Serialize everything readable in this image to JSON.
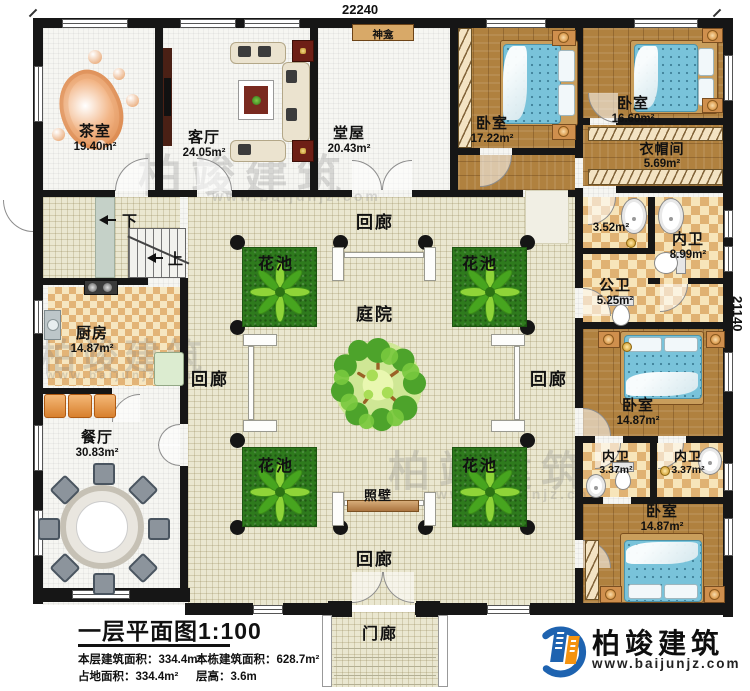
{
  "dimensions": {
    "top": "22240",
    "right": "21140"
  },
  "rooms": {
    "tea_room": {
      "name": "茶室",
      "area": "19.40m²"
    },
    "living_room": {
      "name": "客厅",
      "area": "24.05m²"
    },
    "main_hall": {
      "name": "堂屋",
      "area": "20.43m²"
    },
    "shrine": {
      "name": "神龛"
    },
    "bedroom_top_mid": {
      "name": "卧室",
      "area": "17.22m²"
    },
    "bedroom_top_right": {
      "name": "卧室",
      "area": "16.60m²"
    },
    "cloakroom": {
      "name": "衣帽间",
      "area": "5.69m²"
    },
    "bath_small": {
      "area": "3.52m²"
    },
    "ensuite_main": {
      "name": "内卫",
      "area": "8.99m²"
    },
    "public_bath": {
      "name": "公卫",
      "area": "5.25m²"
    },
    "bedroom_mid_right": {
      "name": "卧室",
      "area": "14.87m²"
    },
    "ensuite_left": {
      "name": "内卫",
      "area": "3.37m²"
    },
    "ensuite_right": {
      "name": "内卫",
      "area": "3.37m²"
    },
    "bedroom_bot_right": {
      "name": "卧室",
      "area": "14.87m²"
    },
    "kitchen": {
      "name": "厨房",
      "area": "14.87m²"
    },
    "dining_room": {
      "name": "餐厅",
      "area": "30.83m²"
    },
    "courtyard": {
      "name": "庭院"
    },
    "flower_bed": {
      "name": "花池"
    },
    "screen_wall": {
      "name": "照壁"
    },
    "corridor": {
      "name": "回廊"
    },
    "porch": {
      "name": "门廊"
    },
    "stair_down": {
      "label": "下"
    },
    "stair_up": {
      "label": "上"
    }
  },
  "title_block": {
    "title": "一层平面图1:100",
    "stats": [
      "本层建筑面积：334.4m²",
      "本栋建筑面积：628.7m²",
      "占地面积：334.4m²",
      "层高：3.6m"
    ]
  },
  "branding": {
    "company": "柏竣建筑",
    "website": "www.baijunjz.com"
  },
  "watermark": {
    "text": "柏竣建筑",
    "site": "www.baijunjz.com"
  },
  "colors": {
    "wall": "#161616",
    "wood_floor": "#b0813f",
    "tile_checker": "#e0b273",
    "courtyard_floor": "#eae7d0",
    "flower_bed": "#2e7a1d",
    "bed_blue": "#79c3da",
    "screen_wall": "#c0895a",
    "logo_blue": "#1e63b0",
    "logo_orange": "#f5930f"
  }
}
